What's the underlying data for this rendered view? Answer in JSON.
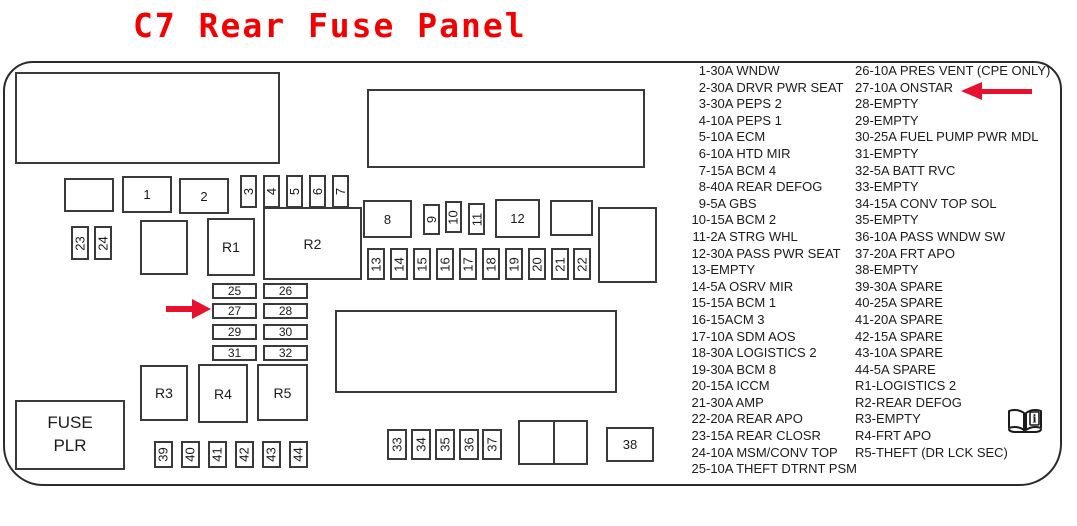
{
  "title": "C7 Rear Fuse Panel",
  "colors": {
    "title_red": "#f40000",
    "arrow_red": "#e8112d",
    "line_color": "#3a3a3a"
  },
  "icons": {
    "fuse27_pointer": "red-arrow-right",
    "onstar_pointer": "red-arrow-left",
    "manual_icon": "open-book-with-i"
  },
  "diagram": {
    "fuse_plr": [
      "FUSE",
      "PLR"
    ],
    "fuses": [
      {
        "id": "fuse-1",
        "label": "1"
      },
      {
        "id": "fuse-2",
        "label": "2"
      },
      {
        "id": "fuse-3",
        "label": "3"
      },
      {
        "id": "fuse-4",
        "label": "4"
      },
      {
        "id": "fuse-5",
        "label": "5"
      },
      {
        "id": "fuse-6",
        "label": "6"
      },
      {
        "id": "fuse-7",
        "label": "7"
      },
      {
        "id": "fuse-8",
        "label": "8"
      },
      {
        "id": "fuse-9",
        "label": "9"
      },
      {
        "id": "fuse-10",
        "label": "10"
      },
      {
        "id": "fuse-11",
        "label": "11"
      },
      {
        "id": "fuse-12",
        "label": "12"
      },
      {
        "id": "fuse-13",
        "label": "13"
      },
      {
        "id": "fuse-14",
        "label": "14"
      },
      {
        "id": "fuse-15",
        "label": "15"
      },
      {
        "id": "fuse-16",
        "label": "16"
      },
      {
        "id": "fuse-17",
        "label": "17"
      },
      {
        "id": "fuse-18",
        "label": "18"
      },
      {
        "id": "fuse-19",
        "label": "19"
      },
      {
        "id": "fuse-20",
        "label": "20"
      },
      {
        "id": "fuse-21",
        "label": "21"
      },
      {
        "id": "fuse-22",
        "label": "22"
      },
      {
        "id": "fuse-23",
        "label": "23"
      },
      {
        "id": "fuse-24",
        "label": "24"
      },
      {
        "id": "fuse-25",
        "label": "25"
      },
      {
        "id": "fuse-26",
        "label": "26"
      },
      {
        "id": "fuse-27",
        "label": "27"
      },
      {
        "id": "fuse-28",
        "label": "28"
      },
      {
        "id": "fuse-29",
        "label": "29"
      },
      {
        "id": "fuse-30",
        "label": "30"
      },
      {
        "id": "fuse-31",
        "label": "31"
      },
      {
        "id": "fuse-32",
        "label": "32"
      },
      {
        "id": "fuse-33",
        "label": "33"
      },
      {
        "id": "fuse-34",
        "label": "34"
      },
      {
        "id": "fuse-35",
        "label": "35"
      },
      {
        "id": "fuse-36",
        "label": "36"
      },
      {
        "id": "fuse-37",
        "label": "37"
      },
      {
        "id": "fuse-38",
        "label": "38"
      },
      {
        "id": "fuse-39",
        "label": "39"
      },
      {
        "id": "fuse-40",
        "label": "40"
      },
      {
        "id": "fuse-41",
        "label": "41"
      },
      {
        "id": "fuse-42",
        "label": "42"
      },
      {
        "id": "fuse-43",
        "label": "43"
      },
      {
        "id": "fuse-44",
        "label": "44"
      },
      {
        "id": "relay-r1",
        "label": "R1"
      },
      {
        "id": "relay-r2",
        "label": "R2"
      },
      {
        "id": "relay-r3",
        "label": "R3"
      },
      {
        "id": "relay-r4",
        "label": "R4"
      },
      {
        "id": "relay-r5",
        "label": "R5"
      }
    ]
  },
  "legend": {
    "column1": [
      "1-30A WNDW",
      "2-30A DRVR PWR SEAT",
      "3-30A PEPS 2",
      "4-10A PEPS 1",
      "5-10A ECM",
      "6-10A HTD MIR",
      "7-15A BCM 4",
      "8-40A REAR DEFOG",
      "9-5A GBS",
      "10-15A BCM 2",
      "11-2A STRG WHL",
      "12-30A PASS PWR SEAT",
      "13-EMPTY",
      "14-5A OSRV MIR",
      "15-15A BCM 1",
      "16-15ACM 3",
      "17-10A SDM AOS",
      "18-30A LOGISTICS 2",
      "19-30A BCM 8",
      "20-15A ICCM",
      "21-30A AMP",
      "22-20A REAR APO",
      "23-15A REAR CLOSR",
      "24-10A MSM/CONV TOP",
      "25-10A THEFT DTRNT PSM"
    ],
    "column2": [
      "26-10A PRES VENT (CPE ONLY)",
      "27-10A ONSTAR",
      "28-EMPTY",
      "29-EMPTY",
      "30-25A FUEL PUMP PWR MDL",
      "31-EMPTY",
      "32-5A BATT RVC",
      "33-EMPTY",
      "34-15A CONV TOP SOL",
      "35-EMPTY",
      "36-10A PASS WNDW SW",
      "37-20A FRT APO",
      "38-EMPTY",
      "39-30A SPARE",
      "40-25A SPARE",
      "41-20A SPARE",
      "42-15A SPARE",
      "43-10A SPARE",
      "44-5A SPARE",
      "R1-LOGISTICS 2",
      "R2-REAR DEFOG",
      "R3-EMPTY",
      "R4-FRT APO",
      "R5-THEFT (DR LCK SEC)"
    ]
  }
}
